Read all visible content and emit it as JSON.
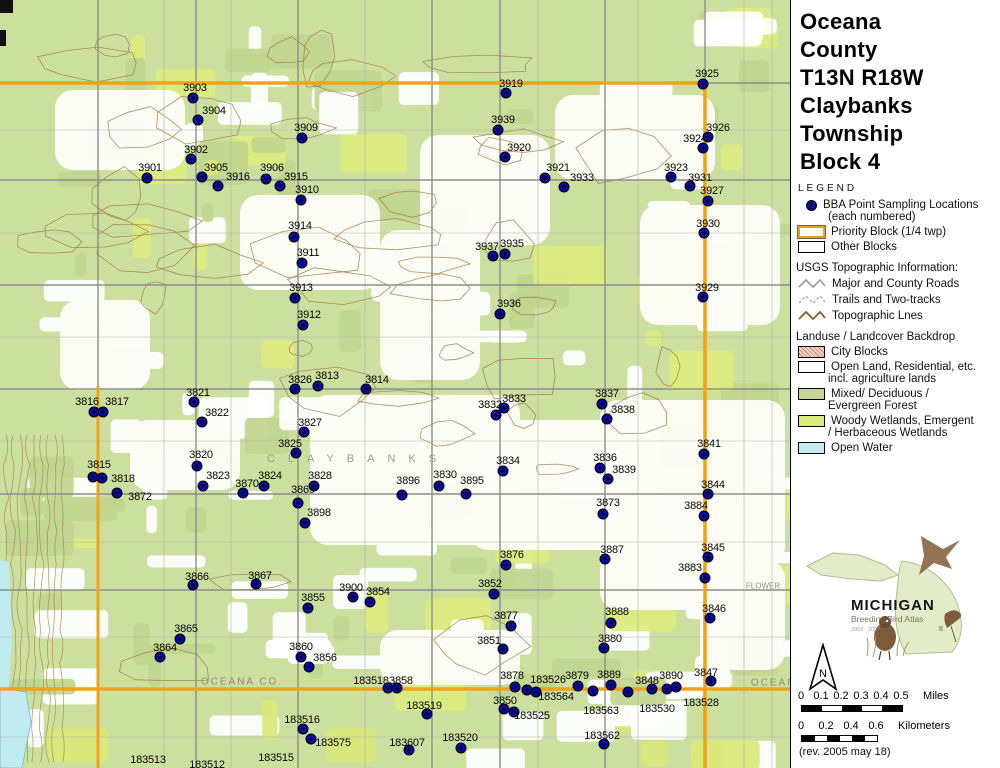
{
  "title": {
    "lines": [
      "Oceana",
      "County",
      "T13N R18W",
      "Claybanks",
      "Township",
      "Block 4"
    ]
  },
  "legend": {
    "heading": "LEGEND",
    "points_item": {
      "label": "BBA Point Sampling Locations",
      "sublabel": "(each numbered)"
    },
    "priority_block_label": "Priority Block (1/4 twp)",
    "other_blocks_label": "Other Blocks",
    "usgs_heading": "USGS Topographic Information:",
    "usgs_items": [
      {
        "icon": "roads-zigzag-icon",
        "label": "Major and County Roads"
      },
      {
        "icon": "trails-zigzag-icon",
        "label": "Trails and Two-tracks"
      },
      {
        "icon": "topo-zigzag-icon",
        "label": "Topographic Lnes"
      }
    ],
    "landuse_heading": "Landuse / Landcover Backdrop",
    "landuse_items": [
      {
        "swatch": "city-blocks",
        "line1": "City Blocks",
        "line2": ""
      },
      {
        "swatch": "open-land",
        "line1": "Open Land, Residential, etc.",
        "line2": "incl. agriculture lands"
      },
      {
        "swatch": "forest",
        "line1": "Mixed/ Deciduous /",
        "line2": "Evergreen Forest"
      },
      {
        "swatch": "wetland",
        "line1": "Woody Wetlands, Emergent",
        "line2": "/ Herbaceous Wetlands"
      },
      {
        "swatch": "open-water",
        "line1": "Open Water",
        "line2": ""
      }
    ]
  },
  "logo": {
    "name": "MICHIGAN",
    "subtitle": "Breeding Bird Atlas",
    "years": "2002 - 2007",
    "numeral": "II"
  },
  "north_label": "N",
  "scalebars": {
    "miles": {
      "ticks": [
        "0",
        "0.1",
        "0.2",
        "0.3",
        "0.4",
        "0.5"
      ],
      "unit": "Miles"
    },
    "kilometers": {
      "ticks": [
        "0",
        "0.2",
        "0.4",
        "0.6"
      ],
      "unit": "Kilometers"
    }
  },
  "revision": "(rev. 2005 may 18)",
  "map": {
    "colors": {
      "boundary": "#EEA41A",
      "dot": "#000080",
      "forest": "#CBDF9F",
      "wetland": "#DCEA7E",
      "water": "#BFEAF0",
      "contour": "#A57A4A"
    },
    "annotations": [
      {
        "text": "OCEANA  CO.",
        "x": 242,
        "y": 682,
        "style": "county"
      },
      {
        "text": "CLAYBANKS",
        "x": 358,
        "y": 459,
        "style": "township"
      },
      {
        "text": "FLOWER",
        "x": 763,
        "y": 586,
        "style": "road"
      },
      {
        "text": "OCEANA",
        "x": 778,
        "y": 683,
        "style": "county"
      }
    ],
    "points_format": [
      "number",
      "dot_x",
      "dot_y",
      "label_x",
      "label_y"
    ],
    "points": [
      [
        "3903",
        193,
        98,
        195,
        88
      ],
      [
        "3904",
        198,
        120,
        214,
        111
      ],
      [
        "3909",
        302,
        138,
        306,
        128
      ],
      [
        "3902",
        191,
        159,
        196,
        150
      ],
      [
        "3901",
        147,
        178,
        150,
        168
      ],
      [
        "3905",
        202,
        177,
        216,
        168
      ],
      [
        "3916",
        218,
        186,
        238,
        177
      ],
      [
        "3906",
        266,
        179,
        272,
        168
      ],
      [
        "3915",
        280,
        186,
        296,
        177
      ],
      [
        "3910",
        301,
        200,
        307,
        190
      ],
      [
        "3914",
        294,
        237,
        300,
        226
      ],
      [
        "3911",
        302,
        263,
        308,
        253
      ],
      [
        "3913",
        295,
        298,
        301,
        288
      ],
      [
        "3912",
        303,
        325,
        309,
        315
      ],
      [
        "3919",
        506,
        93,
        511,
        84
      ],
      [
        "3939",
        498,
        130,
        503,
        120
      ],
      [
        "3920",
        505,
        157,
        519,
        148
      ],
      [
        "3921",
        545,
        178,
        558,
        168
      ],
      [
        "3933",
        564,
        187,
        582,
        178
      ],
      [
        "3925",
        703,
        84,
        707,
        74
      ],
      [
        "3926",
        708,
        137,
        718,
        128
      ],
      [
        "3924",
        703,
        148,
        695,
        139
      ],
      [
        "3923",
        671,
        177,
        676,
        168
      ],
      [
        "3931",
        690,
        186,
        700,
        178
      ],
      [
        "3927",
        708,
        201,
        712,
        191
      ],
      [
        "3930",
        704,
        233,
        708,
        224
      ],
      [
        "3929",
        703,
        297,
        707,
        288
      ],
      [
        "3937",
        493,
        256,
        487,
        247
      ],
      [
        "3935",
        505,
        254,
        512,
        244
      ],
      [
        "3936",
        500,
        314,
        509,
        304
      ],
      [
        "3826",
        295,
        389,
        300,
        380
      ],
      [
        "3813",
        318,
        386,
        327,
        376
      ],
      [
        "3814",
        366,
        389,
        377,
        380
      ],
      [
        "3816",
        94,
        412,
        87,
        402
      ],
      [
        "3817",
        103,
        412,
        117,
        402
      ],
      [
        "3821",
        194,
        402,
        198,
        393
      ],
      [
        "3822",
        202,
        422,
        217,
        413
      ],
      [
        "3827",
        304,
        432,
        310,
        423
      ],
      [
        "3825",
        296,
        453,
        290,
        444
      ],
      [
        "3815",
        93,
        477,
        99,
        465
      ],
      [
        "3818",
        102,
        478,
        123,
        479
      ],
      [
        "3872",
        117,
        493,
        140,
        497
      ],
      [
        "3820",
        197,
        466,
        201,
        455
      ],
      [
        "3823",
        203,
        486,
        218,
        476
      ],
      [
        "3824",
        264,
        486,
        270,
        476
      ],
      [
        "3870",
        243,
        493,
        247,
        484
      ],
      [
        "3869",
        298,
        503,
        303,
        490
      ],
      [
        "3828",
        314,
        486,
        320,
        476
      ],
      [
        "3898",
        305,
        523,
        319,
        513
      ],
      [
        "3896",
        402,
        495,
        408,
        481
      ],
      [
        "3830",
        439,
        486,
        445,
        475
      ],
      [
        "3895",
        466,
        494,
        472,
        481
      ],
      [
        "3834",
        503,
        471,
        508,
        461
      ],
      [
        "3832",
        496,
        415,
        490,
        405
      ],
      [
        "3833",
        504,
        408,
        514,
        399
      ],
      [
        "3837",
        602,
        404,
        607,
        394
      ],
      [
        "3838",
        607,
        419,
        623,
        410
      ],
      [
        "3841",
        704,
        454,
        709,
        444
      ],
      [
        "3836",
        600,
        468,
        605,
        458
      ],
      [
        "3839",
        608,
        479,
        624,
        470
      ],
      [
        "3844",
        708,
        494,
        713,
        485
      ],
      [
        "3873",
        603,
        514,
        608,
        503
      ],
      [
        "3884",
        704,
        516,
        696,
        506
      ],
      [
        "3887",
        605,
        559,
        612,
        550
      ],
      [
        "3876",
        506,
        565,
        512,
        555
      ],
      [
        "3845",
        708,
        557,
        713,
        548
      ],
      [
        "3883",
        705,
        578,
        690,
        568
      ],
      [
        "3846",
        710,
        618,
        714,
        609
      ],
      [
        "3888",
        611,
        623,
        617,
        612
      ],
      [
        "3880",
        604,
        648,
        610,
        639
      ],
      [
        "3866",
        193,
        585,
        197,
        577
      ],
      [
        "3867",
        256,
        584,
        260,
        576
      ],
      [
        "3855",
        308,
        608,
        313,
        598
      ],
      [
        "3900",
        353,
        597,
        351,
        588
      ],
      [
        "3854",
        370,
        602,
        378,
        592
      ],
      [
        "3865",
        180,
        639,
        186,
        629
      ],
      [
        "3864",
        160,
        657,
        165,
        648
      ],
      [
        "3860",
        301,
        657,
        301,
        647
      ],
      [
        "3856",
        309,
        667,
        325,
        658
      ],
      [
        "3852",
        494,
        594,
        490,
        584
      ],
      [
        "3877",
        511,
        626,
        506,
        616
      ],
      [
        "3851",
        503,
        649,
        489,
        641
      ],
      [
        "183518",
        388,
        688,
        371,
        681
      ],
      [
        "3858",
        397,
        688,
        401,
        681
      ],
      [
        "3878",
        515,
        687,
        512,
        676
      ],
      [
        "183526",
        527,
        690,
        548,
        680
      ],
      [
        "183564",
        536,
        692,
        556,
        697
      ],
      [
        "3879",
        578,
        686,
        577,
        676
      ],
      [
        "183563",
        593,
        691,
        601,
        711
      ],
      [
        "3889",
        611,
        685,
        609,
        675
      ],
      [
        "183530",
        628,
        692,
        657,
        709
      ],
      [
        "3848",
        652,
        689,
        647,
        681
      ],
      [
        "3890",
        667,
        689,
        671,
        676
      ],
      [
        "183528",
        676,
        687,
        701,
        703
      ],
      [
        "3847",
        711,
        681,
        706,
        673
      ],
      [
        "3850",
        504,
        709,
        505,
        701
      ],
      [
        "183525",
        514,
        712,
        532,
        716
      ],
      [
        "183519",
        427,
        714,
        424,
        706
      ],
      [
        "183516",
        303,
        729,
        302,
        720
      ],
      [
        "183575",
        311,
        739,
        333,
        743
      ],
      [
        "183607",
        409,
        750,
        407,
        743
      ],
      [
        "183520",
        461,
        748,
        460,
        738
      ],
      [
        "183562",
        604,
        744,
        602,
        736
      ],
      [
        "183513",
        -1,
        -1,
        148,
        760
      ],
      [
        "183512",
        -1,
        -1,
        207,
        765
      ],
      [
        "183515",
        -1,
        -1,
        276,
        758
      ]
    ]
  }
}
